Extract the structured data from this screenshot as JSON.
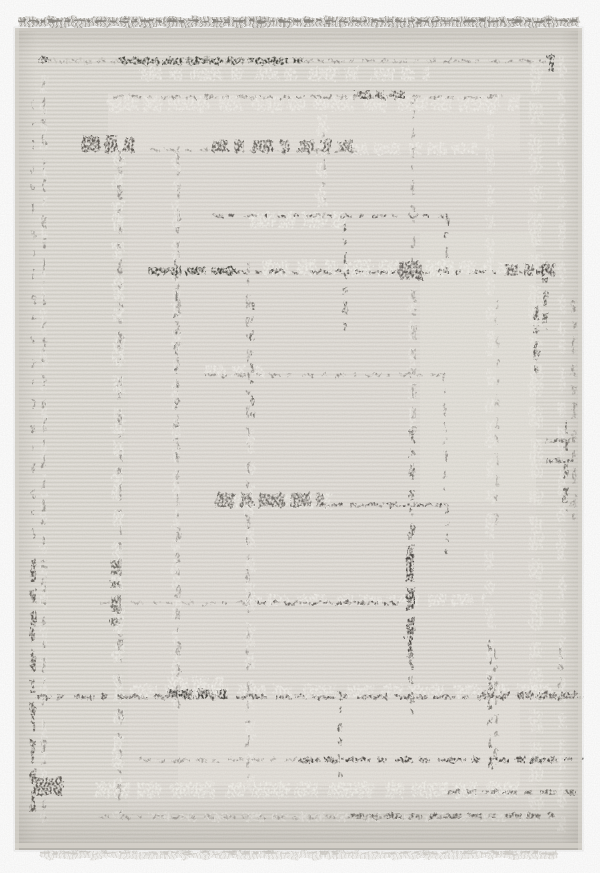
{
  "scene": {
    "subject": "beige distressed geometric area rug with fringe, product photo",
    "background_color": "#ffffff"
  },
  "rug": {
    "geometry": {
      "x": 15,
      "y": 28,
      "width": 567,
      "height": 822
    },
    "base_color": "#e0ddd6",
    "weave_highlight": "rgba(255,255,255,0.22)",
    "weave_shadow": "rgba(99,93,84,0.08)",
    "edge_top_color": "#cdcac3",
    "edge_side_color": "#d6d3cc",
    "edge_bottom_band": "#d3d0c9",
    "edge_bottom_line": "#a6a39d",
    "palette": {
      "k": "#35332f",
      "d": "#4a4641",
      "m": "#8c8882",
      "g": "#b7b3ab",
      "s": "#f4f2ed",
      "w": "#fcfbf8",
      "patch": "#e9e6e0"
    },
    "fringe": {
      "top": {
        "x": 18,
        "y": 17,
        "width": 562,
        "height": 10,
        "main": "#a9a6a0",
        "dark": "#85827c",
        "light": "#cbc8c2"
      },
      "bottom": {
        "x": 40,
        "y": 851,
        "width": 518,
        "height": 8,
        "main": "#dddbd6",
        "light": "#edebe7",
        "line": "#d0cdc7"
      }
    },
    "patch_format": "[x, y, w, h, opacity]",
    "patches": [
      [
        108,
        93,
        412,
        58,
        0.5
      ],
      [
        420,
        232,
        116,
        270,
        0.45
      ],
      [
        178,
        700,
        342,
        86,
        0.5
      ],
      [
        128,
        120,
        408,
        690,
        0.2
      ]
    ],
    "segment_format": "[orientation h|v, x, y, length, stroke_width, tone, dash_pattern, opacity]",
    "segments": [
      [
        "h",
        45,
        61,
        75,
        5,
        "g",
        "12 8 8 6",
        0.5
      ],
      [
        "h",
        140,
        74,
        290,
        13,
        "s",
        "22 6 14 10 30 8 12 14",
        0.8
      ],
      [
        "h",
        108,
        104,
        412,
        15,
        "s",
        "30 5 18 8 40 10 22 12",
        0.75
      ],
      [
        "h",
        350,
        149,
        132,
        12,
        "s",
        "18 6 26 9 12 7",
        0.8
      ],
      [
        "v",
        118,
        140,
        678,
        11,
        "s",
        "26 8 14 12 32 10 18 14",
        0.7
      ],
      [
        "v",
        176,
        150,
        560,
        8,
        "s",
        "20 10 12 8 28 12",
        0.6
      ],
      [
        "v",
        322,
        92,
        118,
        10,
        "s",
        "16 7 22 9 10 6",
        0.75
      ],
      [
        "v",
        44,
        75,
        748,
        6,
        "s",
        "18 12 10 10 26 16",
        0.5
      ],
      [
        "h",
        250,
        220,
        95,
        16,
        "s",
        "24 5 16 7",
        0.85
      ],
      [
        "h",
        262,
        268,
        200,
        16,
        "s",
        "28 6 20 8 14 6",
        0.85
      ],
      [
        "h",
        458,
        268,
        62,
        12,
        "s",
        "18 5 12 6",
        0.8
      ],
      [
        "v",
        412,
        262,
        170,
        7,
        "s",
        "18 8 24 10",
        0.6
      ],
      [
        "h",
        205,
        371,
        58,
        11,
        "s",
        "20 6 14 7",
        0.8
      ],
      [
        "h",
        228,
        501,
        104,
        15,
        "s",
        "26 6 18 8",
        0.85
      ],
      [
        "h",
        245,
        600,
        240,
        11,
        "s",
        "16 6 22 8 30 10",
        0.8
      ],
      [
        "v",
        250,
        430,
        362,
        9,
        "s",
        "22 9 14 10 30 12",
        0.6
      ],
      [
        "v",
        490,
        95,
        610,
        8,
        "s",
        "20 10 14 9 26 12",
        0.6
      ],
      [
        "v",
        536,
        60,
        756,
        13,
        "s",
        "34 8 22 10 40 12 16 10",
        0.55
      ],
      [
        "v",
        562,
        55,
        786,
        7,
        "s",
        "24 10 16 10 30 14",
        0.6
      ],
      [
        "h",
        130,
        691,
        430,
        12,
        "s",
        "28 7 20 9 34 10",
        0.8
      ],
      [
        "h",
        95,
        790,
        424,
        15,
        "s",
        "36 6 24 10 44 12 18 8",
        0.85
      ],
      [
        "h",
        150,
        817,
        408,
        8,
        "s",
        "22 8 16 8 28 10",
        0.75
      ],
      [
        "h",
        168,
        686,
        55,
        18,
        "s",
        "20 5 14 6",
        0.8
      ],
      [
        "h",
        45,
        61,
        76,
        2,
        "m",
        "8 6 5 7",
        0.7
      ],
      [
        "h",
        300,
        61,
        246,
        2.5,
        "m",
        "12 5 7 4 16 6 5 8",
        0.8
      ],
      [
        "h",
        112,
        97,
        392,
        3,
        "m",
        "10 6 14 5 6 9 18 7",
        0.85
      ],
      [
        "h",
        150,
        150,
        208,
        2.5,
        "m",
        "9 6 13 7 5 10",
        0.75
      ],
      [
        "v",
        44,
        80,
        740,
        2.5,
        "m",
        "8 10 14 8 4 12 10 14",
        0.8
      ],
      [
        "v",
        120,
        150,
        665,
        3,
        "m",
        "10 8 6 10 16 9 4 12",
        0.8
      ],
      [
        "v",
        178,
        152,
        556,
        3,
        "m",
        "12 7 5 9 14 10",
        0.7
      ],
      [
        "v",
        324,
        130,
        88,
        2.5,
        "m",
        "6 9 4 11 9 12",
        0.7
      ],
      [
        "v",
        248,
        262,
        528,
        2.5,
        "m",
        "9 8 5 11 13 9",
        0.8
      ],
      [
        "v",
        413,
        95,
        167,
        2.5,
        "m",
        "9 8 5 10 13 9",
        0.7
      ],
      [
        "v",
        414,
        290,
        150,
        4,
        "m",
        "11 8 6 10 15 9",
        0.6
      ],
      [
        "h",
        205,
        375,
        240,
        2.5,
        "m",
        "11 6 5 8 15 7 4 9",
        0.85
      ],
      [
        "v",
        445,
        375,
        115,
        2,
        "m",
        "8 7 4 9 12 8",
        0.8
      ],
      [
        "h",
        320,
        505,
        130,
        3,
        "m",
        "12 6 6 9 16 7",
        0.8
      ],
      [
        "h",
        100,
        603,
        110,
        2.5,
        "m",
        "9 7 4 10 12 9",
        0.6
      ],
      [
        "h",
        205,
        603,
        195,
        2.5,
        "m",
        "10 7 5 9 14 8",
        0.8
      ],
      [
        "v",
        497,
        300,
        235,
        2.5,
        "m",
        "9 10 5 12 12 11",
        0.55
      ],
      [
        "h",
        140,
        760,
        158,
        3,
        "m",
        "11 7 6 9 15 8",
        0.7
      ],
      [
        "h",
        100,
        817,
        355,
        3,
        "m",
        "10 8 14 6 5 9",
        0.65
      ],
      [
        "v",
        574,
        300,
        232,
        3.5,
        "m",
        "12 9 7 10 16 11",
        0.7
      ],
      [
        "v",
        496,
        648,
        118,
        3,
        "m",
        "10 8 6 9",
        0.75
      ],
      [
        "v",
        560,
        648,
        60,
        3,
        "m",
        "9 8 5 9",
        0.7
      ],
      [
        "h",
        40,
        60,
        7,
        7,
        "k",
        "7",
        0.85
      ],
      [
        "h",
        118,
        61,
        186,
        6.5,
        "k",
        "40 4 22 3 34 5 18 4",
        0.9
      ],
      [
        "v",
        551,
        55,
        17,
        6,
        "k",
        "17",
        0.8
      ],
      [
        "h",
        355,
        95,
        50,
        8,
        "d",
        "16 4 10 5 20 4",
        0.85
      ],
      [
        "h",
        82,
        144,
        52,
        15,
        "d",
        "18 5 12 6",
        0.85
      ],
      [
        "h",
        212,
        146,
        140,
        12,
        "d",
        "16 6 10 8 22 7 8 10",
        0.75
      ],
      [
        "h",
        212,
        216,
        236,
        2.5,
        "d",
        "10 6 6 8 14 7 5 9",
        0.8
      ],
      [
        "v",
        447,
        216,
        55,
        2.5,
        "d",
        "9 7 5 9 12 8",
        0.8
      ],
      [
        "v",
        345,
        224,
        108,
        2.5,
        "d",
        "8 7 5 9 12 8",
        0.75
      ],
      [
        "v",
        252,
        300,
        128,
        3,
        "d",
        "9 8 5 10",
        0.7
      ],
      [
        "h",
        148,
        271,
        88,
        7,
        "k",
        "34 4 20 5 26 6",
        0.9
      ],
      [
        "h",
        236,
        272,
        312,
        3,
        "d",
        "14 5 8 6 18 5 6 8 24 6",
        0.85
      ],
      [
        "h",
        398,
        271,
        24,
        18,
        "d",
        "24",
        0.8
      ],
      [
        "h",
        505,
        270,
        54,
        11,
        "d",
        "14 5 9 6 16 5",
        0.8
      ],
      [
        "v",
        545,
        262,
        68,
        4,
        "d",
        "10 6 6 8 14 7",
        0.75
      ],
      [
        "v",
        536,
        305,
        68,
        5,
        "d",
        "14 6 9 7 18 8",
        0.8
      ],
      [
        "h",
        546,
        441,
        24,
        4,
        "d",
        "24",
        0.7
      ],
      [
        "h",
        546,
        460,
        28,
        3,
        "d",
        "28",
        0.65
      ],
      [
        "v",
        410,
        545,
        118,
        7,
        "k",
        "36 6 24 7 40 8",
        0.88
      ],
      [
        "v",
        412,
        430,
        118,
        4,
        "d",
        "12 7 7 9 16 8",
        0.7
      ],
      [
        "v",
        412,
        660,
        55,
        3,
        "d",
        "10 7 6 9",
        0.7
      ],
      [
        "h",
        215,
        500,
        108,
        14,
        "d",
        "20 5 13 6 26 6",
        0.75
      ],
      [
        "h",
        332,
        505,
        118,
        3,
        "d",
        "12 5 7 7 16 6",
        0.8
      ],
      [
        "v",
        447,
        505,
        56,
        2.5,
        "d",
        "9 6 5 8",
        0.75
      ],
      [
        "h",
        255,
        603,
        148,
        3,
        "d",
        "11 5 6 8 14 6",
        0.8
      ],
      [
        "v",
        115,
        560,
        66,
        8,
        "d",
        "14 6 9 7 16 6",
        0.75
      ],
      [
        "v",
        33,
        100,
        450,
        2,
        "d",
        "8 12 5 14 10 16",
        0.5
      ],
      [
        "v",
        33,
        560,
        252,
        4.5,
        "d",
        "22 7 14 8 30 9",
        0.85
      ],
      [
        "h",
        35,
        697,
        548,
        4,
        "d",
        "16 6 9 7 22 6 7 9 30 8",
        0.8
      ],
      [
        "h",
        168,
        694,
        58,
        9,
        "k",
        "24 5 14 6",
        0.85
      ],
      [
        "h",
        480,
        695,
        100,
        6,
        "d",
        "15 5 9 6 20 5",
        0.8
      ],
      [
        "v",
        340,
        690,
        96,
        3,
        "d",
        "10 7 6 9",
        0.75
      ],
      [
        "h",
        300,
        760,
        284,
        4.5,
        "k",
        "20 5 12 6 28 6 9 8",
        0.85
      ],
      [
        "h",
        35,
        786,
        28,
        17,
        "d",
        "28",
        0.85
      ],
      [
        "h",
        448,
        792,
        132,
        4,
        "d",
        "13 6 8 7 17 6",
        0.7
      ],
      [
        "h",
        350,
        816,
        212,
        5,
        "d",
        "14 6 8 7 18 6",
        0.75
      ],
      [
        "v",
        490,
        640,
        132,
        3,
        "d",
        "11 8 6 10 15 9",
        0.7
      ],
      [
        "v",
        566,
        420,
        92,
        4,
        "d",
        "14 8 9 9 18 10",
        0.7
      ],
      [
        "v",
        176,
        260,
        200,
        3,
        "d",
        "6 10 4 12 9 13",
        0.6
      ]
    ]
  }
}
